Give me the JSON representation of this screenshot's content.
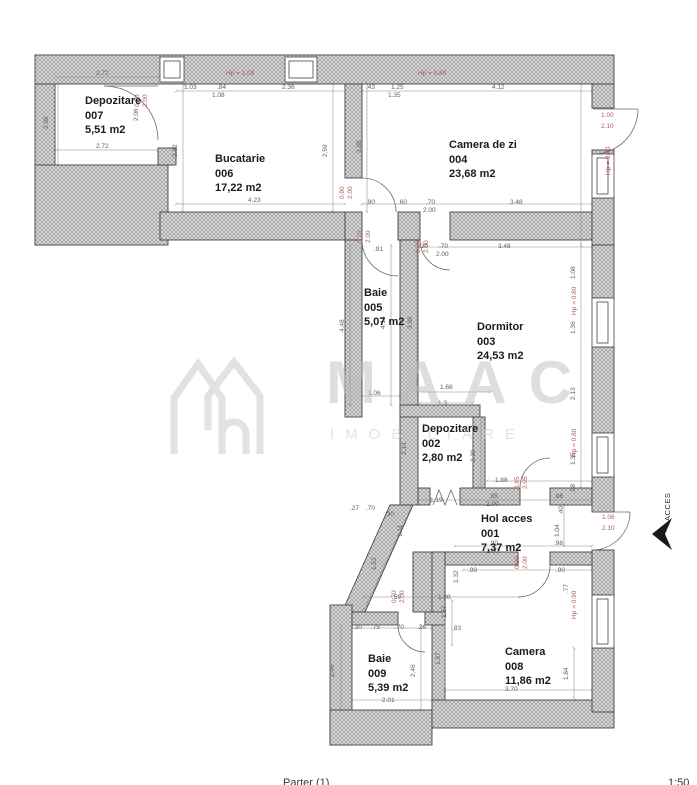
{
  "footer": {
    "floor": "Parter (1)",
    "scale": "1:50"
  },
  "watermark": {
    "line1": "MAAC",
    "line2": "IMOBILIARE"
  },
  "access_label": "ACCES",
  "colors": {
    "wall_fill": "#d8d8d8",
    "wall_hatch": "#8f8f8f",
    "outline": "#454545",
    "dim_text": "#5f5f5f",
    "red_text": "#b05c54",
    "watermark": "#c6c6c6"
  },
  "rooms": [
    {
      "name": "Depozitare",
      "number": "007",
      "area": "5,51 m2"
    },
    {
      "name": "Bucatarie",
      "number": "006",
      "area": "17,22 m2"
    },
    {
      "name": "Camera de zi",
      "number": "004",
      "area": "23,68 m2"
    },
    {
      "name": "Baie",
      "number": "005",
      "area": "5,07 m2"
    },
    {
      "name": "Dormitor",
      "number": "003",
      "area": "24,53 m2"
    },
    {
      "name": "Depozitare",
      "number": "002",
      "area": "2,80 m2"
    },
    {
      "name": "Hol acces",
      "number": "001",
      "area": "7,37 m2"
    },
    {
      "name": "Camera",
      "number": "008",
      "area": "11,86 m2"
    },
    {
      "name": "Baie",
      "number": "009",
      "area": "5,39 m2"
    }
  ],
  "dim_labels": [
    {
      "t": "2.72",
      "x": 96,
      "y": 70
    },
    {
      "t": "2.72",
      "x": 96,
      "y": 143
    },
    {
      "t": "1.03",
      "x": 184,
      "y": 84
    },
    {
      "t": ".84",
      "x": 217,
      "y": 84
    },
    {
      "t": "1.08",
      "x": 212,
      "y": 92
    },
    {
      "t": "2.36",
      "x": 282,
      "y": 84
    },
    {
      "t": "4.23",
      "x": 248,
      "y": 197
    },
    {
      "t": ".43",
      "x": 366,
      "y": 84
    },
    {
      "t": "1.25",
      "x": 391,
      "y": 84
    },
    {
      "t": "1.35",
      "x": 388,
      "y": 92
    },
    {
      "t": "4.12",
      "x": 492,
      "y": 84
    },
    {
      "t": ".90",
      "x": 366,
      "y": 199
    },
    {
      "t": ".60",
      "x": 398,
      "y": 199
    },
    {
      "t": ".70",
      "x": 426,
      "y": 199
    },
    {
      "t": "2.00",
      "x": 423,
      "y": 207
    },
    {
      "t": "3.48",
      "x": 510,
      "y": 199
    },
    {
      "t": ".91",
      "x": 374,
      "y": 246
    },
    {
      "t": "3.48",
      "x": 498,
      "y": 243
    },
    {
      "t": ".20",
      "x": 419,
      "y": 243
    },
    {
      "t": ".70",
      "x": 439,
      "y": 243
    },
    {
      "t": "2.00",
      "x": 436,
      "y": 251
    },
    {
      "t": "1.68",
      "x": 440,
      "y": 384
    },
    {
      "t": "1.06",
      "x": 368,
      "y": 390
    },
    {
      "t": "1.3",
      "x": 438,
      "y": 400
    },
    {
      "t": "1.88",
      "x": 495,
      "y": 477
    },
    {
      "t": "1.19",
      "x": 430,
      "y": 497
    },
    {
      "t": ".85",
      "x": 489,
      "y": 493
    },
    {
      "t": "2.00",
      "x": 486,
      "y": 501
    },
    {
      "t": ".98",
      "x": 554,
      "y": 493
    },
    {
      "t": ".90",
      "x": 489,
      "y": 540
    },
    {
      "t": "2.00",
      "x": 486,
      "y": 548
    },
    {
      "t": ".98",
      "x": 554,
      "y": 540
    },
    {
      "t": ".27",
      "x": 350,
      "y": 505
    },
    {
      "t": ".70",
      "x": 366,
      "y": 505
    },
    {
      "t": ".30",
      "x": 385,
      "y": 511
    },
    {
      "t": ".59",
      "x": 392,
      "y": 594
    },
    {
      "t": "1.08",
      "x": 438,
      "y": 594
    },
    {
      "t": ".99",
      "x": 468,
      "y": 567
    },
    {
      "t": ".90",
      "x": 556,
      "y": 567
    },
    {
      "t": ".83",
      "x": 452,
      "y": 625
    },
    {
      "t": "3.70",
      "x": 505,
      "y": 686
    },
    {
      "t": ".30",
      "x": 353,
      "y": 624
    },
    {
      "t": ".75",
      "x": 371,
      "y": 624
    },
    {
      "t": ".70",
      "x": 395,
      "y": 624
    },
    {
      "t": ".26",
      "x": 417,
      "y": 624
    },
    {
      "t": "2.01",
      "x": 382,
      "y": 697
    },
    {
      "t": "2.08",
      "x": 50,
      "y": 122,
      "v": 1
    },
    {
      "t": "2.06",
      "x": 140,
      "y": 114,
      "v": 1
    },
    {
      "t": "3.92",
      "x": 179,
      "y": 150,
      "v": 1
    },
    {
      "t": "2.59",
      "x": 329,
      "y": 150,
      "v": 1
    },
    {
      "t": "3.88",
      "x": 363,
      "y": 146,
      "v": 1
    },
    {
      "t": "1.08",
      "x": 577,
      "y": 272,
      "v": 1
    },
    {
      "t": "1.36",
      "x": 577,
      "y": 327,
      "v": 1
    },
    {
      "t": "2.13",
      "x": 577,
      "y": 393,
      "v": 1
    },
    {
      "t": "1.35",
      "x": 577,
      "y": 458,
      "v": 1
    },
    {
      "t": ".98",
      "x": 577,
      "y": 486,
      "v": 1
    },
    {
      "t": "4.48",
      "x": 346,
      "y": 325,
      "v": 1
    },
    {
      "t": "4.14",
      "x": 387,
      "y": 322,
      "v": 1
    },
    {
      "t": "3.99",
      "x": 414,
      "y": 322,
      "v": 1
    },
    {
      "t": "2.14",
      "x": 408,
      "y": 448,
      "v": 1
    },
    {
      "t": "2.29",
      "x": 477,
      "y": 455,
      "v": 1
    },
    {
      "t": ".40",
      "x": 565,
      "y": 508,
      "v": 1
    },
    {
      "t": "1.04",
      "x": 561,
      "y": 530,
      "v": 1
    },
    {
      "t": "1.11",
      "x": 404,
      "y": 530,
      "v": 1
    },
    {
      "t": "1.52",
      "x": 378,
      "y": 563,
      "v": 1
    },
    {
      "t": "1.32",
      "x": 460,
      "y": 576,
      "v": 1
    },
    {
      "t": ".77",
      "x": 570,
      "y": 586,
      "v": 1
    },
    {
      "t": "1.57",
      "x": 448,
      "y": 611,
      "v": 1
    },
    {
      "t": "1.97",
      "x": 442,
      "y": 658,
      "v": 1
    },
    {
      "t": "1.84",
      "x": 570,
      "y": 673,
      "v": 1
    },
    {
      "t": "2.46",
      "x": 336,
      "y": 670,
      "v": 1
    },
    {
      "t": "2.46",
      "x": 417,
      "y": 670,
      "v": 1
    },
    {
      "t": "Hp = 1.09",
      "x": 226,
      "y": 70,
      "red": 1
    },
    {
      "t": "Hp = 0.80",
      "x": 418,
      "y": 70,
      "red": 1
    },
    {
      "t": "0.90",
      "x": 141,
      "y": 100,
      "v": 1,
      "red": 1
    },
    {
      "t": "2.00",
      "x": 149,
      "y": 100,
      "v": 1,
      "red": 1
    },
    {
      "t": "0.90",
      "x": 346,
      "y": 192,
      "v": 1,
      "red": 1
    },
    {
      "t": "2.00",
      "x": 354,
      "y": 192,
      "v": 1,
      "red": 1
    },
    {
      "t": "1.00",
      "x": 601,
      "y": 112,
      "red": 1
    },
    {
      "t": "2.10",
      "x": 601,
      "y": 123,
      "red": 1
    },
    {
      "t": "Hp = 0.80",
      "x": 612,
      "y": 168,
      "v": 1,
      "red": 1
    },
    {
      "t": "0.70",
      "x": 364,
      "y": 236,
      "v": 1,
      "red": 1
    },
    {
      "t": "2.00",
      "x": 372,
      "y": 236,
      "v": 1,
      "red": 1
    },
    {
      "t": "0.80",
      "x": 422,
      "y": 246,
      "v": 1,
      "red": 1
    },
    {
      "t": "2.00",
      "x": 430,
      "y": 246,
      "v": 1,
      "red": 1
    },
    {
      "t": "Hp = 0.80",
      "x": 578,
      "y": 308,
      "v": 1,
      "red": 1
    },
    {
      "t": "Hp = 0.80",
      "x": 578,
      "y": 450,
      "v": 1,
      "red": 1
    },
    {
      "t": "0.85",
      "x": 521,
      "y": 482,
      "v": 1,
      "red": 1
    },
    {
      "t": "2.05",
      "x": 529,
      "y": 482,
      "v": 1,
      "red": 1
    },
    {
      "t": "1.06",
      "x": 602,
      "y": 514,
      "red": 1
    },
    {
      "t": "2.10",
      "x": 602,
      "y": 525,
      "red": 1
    },
    {
      "t": "0.90",
      "x": 521,
      "y": 562,
      "v": 1,
      "red": 1
    },
    {
      "t": "2.00",
      "x": 529,
      "y": 562,
      "v": 1,
      "red": 1
    },
    {
      "t": "0.70",
      "x": 398,
      "y": 596,
      "v": 1,
      "red": 1
    },
    {
      "t": "2.00",
      "x": 406,
      "y": 596,
      "v": 1,
      "red": 1
    },
    {
      "t": "Hp = 0.90",
      "x": 578,
      "y": 612,
      "v": 1,
      "red": 1
    }
  ]
}
